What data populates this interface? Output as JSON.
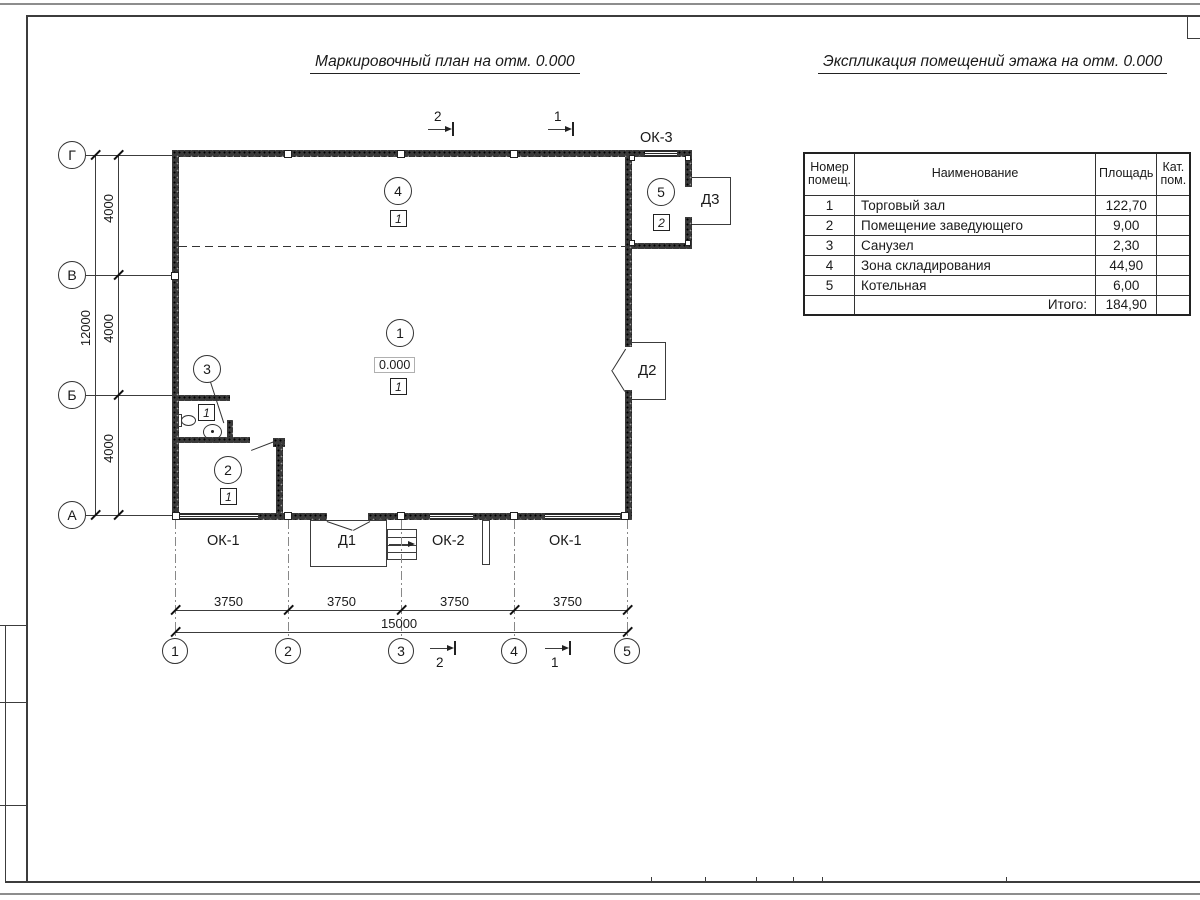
{
  "titles": {
    "plan": "Маркировочный план на отм. 0.000",
    "explication": "Экспликация помещений этажа на отм. 0.000"
  },
  "table": {
    "headers": {
      "number": "Номер помещ.",
      "name": "Наименование",
      "area": "Площадь",
      "category": "Кат. пом."
    },
    "rows": [
      {
        "num": "1",
        "name": "Торговый зал",
        "area": "122,70"
      },
      {
        "num": "2",
        "name": "Помещение заведующего",
        "area": "9,00"
      },
      {
        "num": "3",
        "name": "Санузел",
        "area": "2,30"
      },
      {
        "num": "4",
        "name": "Зона складирования",
        "area": "44,90"
      },
      {
        "num": "5",
        "name": "Котельная",
        "area": "6,00"
      }
    ],
    "total": {
      "label": "Итого:",
      "value": "184,90"
    }
  },
  "axes": {
    "rows": [
      "Г",
      "В",
      "Б",
      "А"
    ],
    "cols": [
      "1",
      "2",
      "3",
      "4",
      "5"
    ]
  },
  "dims": {
    "left_segments": [
      "4000",
      "4000",
      "4000"
    ],
    "left_total": "12000",
    "bottom_segments": [
      "3750",
      "3750",
      "3750",
      "3750"
    ],
    "bottom_total": "15000"
  },
  "rooms": [
    {
      "number": "1",
      "floor_type": "1",
      "elevation": "0.000"
    },
    {
      "number": "2",
      "floor_type": "1"
    },
    {
      "number": "3",
      "floor_type": "1"
    },
    {
      "number": "4",
      "floor_type": "1"
    },
    {
      "number": "5",
      "floor_type": "2"
    }
  ],
  "openings": {
    "window_left": "ОК-1",
    "window_center": "ОК-2",
    "window_right": "ОК-1",
    "window_top": "ОК-3",
    "door_main": "Д1",
    "door_side": "Д2",
    "door_boiler": "Д3"
  },
  "sections": {
    "section_1": "1",
    "section_2": "2"
  }
}
